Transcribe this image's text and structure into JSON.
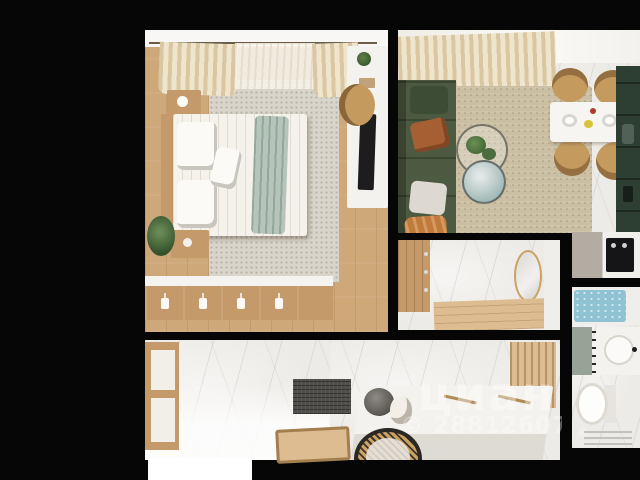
{
  "watermark": {
    "brand": "циан",
    "license": "© 28812607"
  },
  "palette": {
    "background": "#060606",
    "wood_floor": "#cfa87a",
    "wood_light": "#dcbc90",
    "wood_furniture": "#c49a6a",
    "marble_floor": "#edebe7",
    "curtain_beige": "#d9c6a2",
    "sofa_green": "#4c5a41",
    "kitchen_green": "#2d3f33",
    "teal_furniture": "#7db7b1",
    "mint_frame": "#a6d0c2",
    "rug_sand": "#cbbfa3",
    "rug_gray": "#d9d5ca",
    "rug_dots_bg": "#efe8da",
    "bedding_white": "#f5f2ec",
    "sage_throw": "#b5c5bb",
    "orange_throw": "#c07a3c",
    "rust_pillow": "#a65f33",
    "tan_chair": "#c59a5f",
    "water_teal": "#8fc2d3",
    "gray_mat": "#4f4e4b",
    "rattan": "#c9a264",
    "white_furniture": "#f4f2ee",
    "appliance_black": "#151517",
    "watermark_white": "#ffffff"
  }
}
